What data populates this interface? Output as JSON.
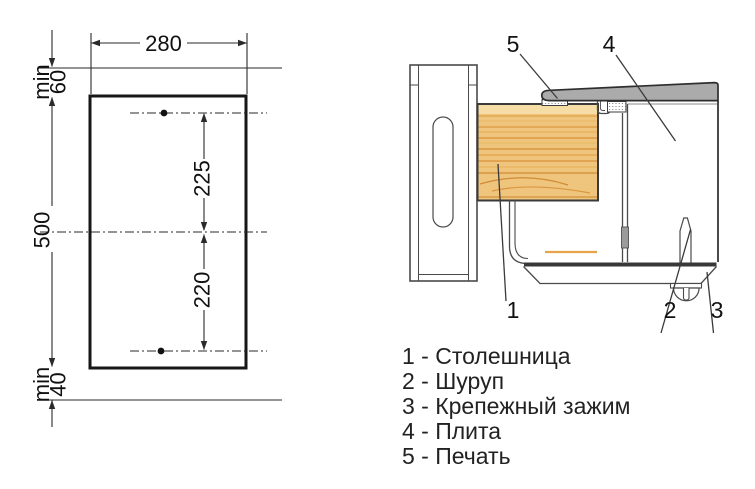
{
  "cutout": {
    "width": "280",
    "height": "500",
    "hole_spacing_top": "225",
    "hole_spacing_bottom": "220",
    "clearance_top_label": "min",
    "clearance_top_value": "60",
    "clearance_bottom_label": "min",
    "clearance_bottom_value": "40"
  },
  "section": {
    "callout_1": "1",
    "callout_2": "2",
    "callout_3": "3",
    "callout_4": "4",
    "callout_5": "5"
  },
  "legend": {
    "items": [
      "1 - Столешница",
      "2 - Шуруп",
      "3 - Крепежный зажим",
      "4 - Плита",
      "5 - Печать"
    ]
  },
  "colors": {
    "plate_gray": "#ababab",
    "wood_base": "#efc57e",
    "wood_grain": "#dd9a42",
    "heater_line": "#e6a348",
    "seal_dot": "#555555",
    "line_dark": "#2a2a2a"
  }
}
